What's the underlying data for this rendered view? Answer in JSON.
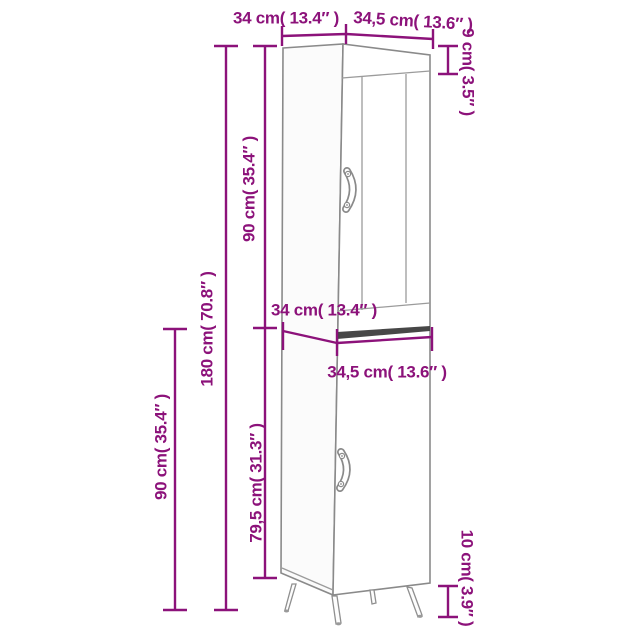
{
  "figure": {
    "kind": "furniture dimension diagram",
    "subject": "tall narrow cabinet with upper glass door, lower door and splayed legs",
    "accent_color": "#8C127A",
    "line_color": "#8a8a8a"
  },
  "dimensions": {
    "top_depth": "34 cm( 13.4″ )",
    "top_width": "34,5 cm( 13.6″ )",
    "top_section_height": "9 cm( 3.5″ )",
    "upper_section_height": "90 cm( 35.4″ )",
    "total_height": "180 cm( 70.8″ )",
    "lower_section_height": "90 cm( 35.4″ )",
    "middle_depth": "34 cm( 13.4″ )",
    "middle_width": "34,5 cm( 13.6″ )",
    "lower_door_height": "79,5 cm( 31.3″ )",
    "leg_height": "10 cm( 3.9″ )"
  }
}
